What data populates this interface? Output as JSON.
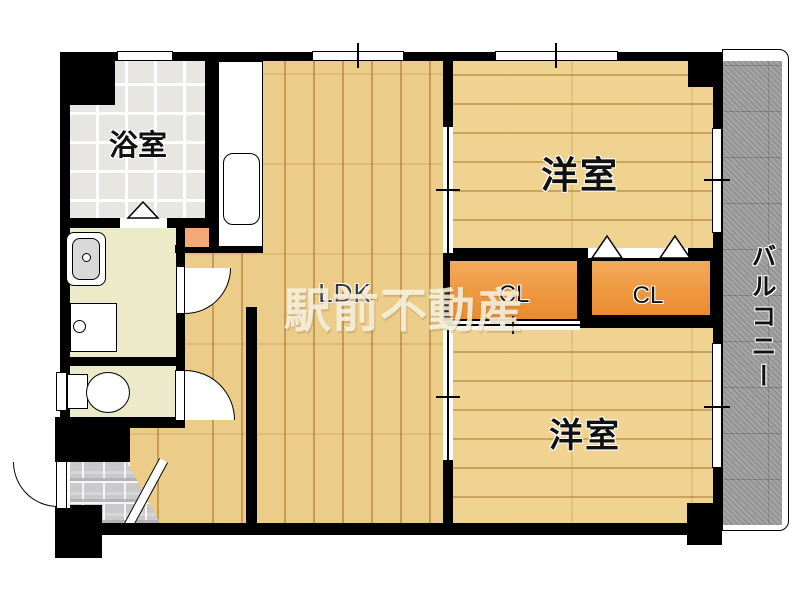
{
  "floorplan": {
    "watermark": "駅前不動産",
    "labels": {
      "bathroom": "浴室",
      "western_room_upper": "洋室",
      "western_room_lower": "洋室",
      "ldk": "LDK",
      "closet_left": "CL",
      "closet_right": "CL",
      "balcony": "バルコニー"
    },
    "colors": {
      "wall": "#000000",
      "ldk_wood_floor": "#e9c77c",
      "room_wood_floor": "#eecf85",
      "closet_fill": "#ee9840",
      "bathroom_tile": "#e7e6e2",
      "washroom_floor": "#eceac8",
      "genkan_tile": "#c9c9cb",
      "balcony_floor": "#9e9e9e",
      "water_heater_box": "#f2a877",
      "watermark_color": "#f6f0de",
      "label_color": "#111111"
    }
  }
}
